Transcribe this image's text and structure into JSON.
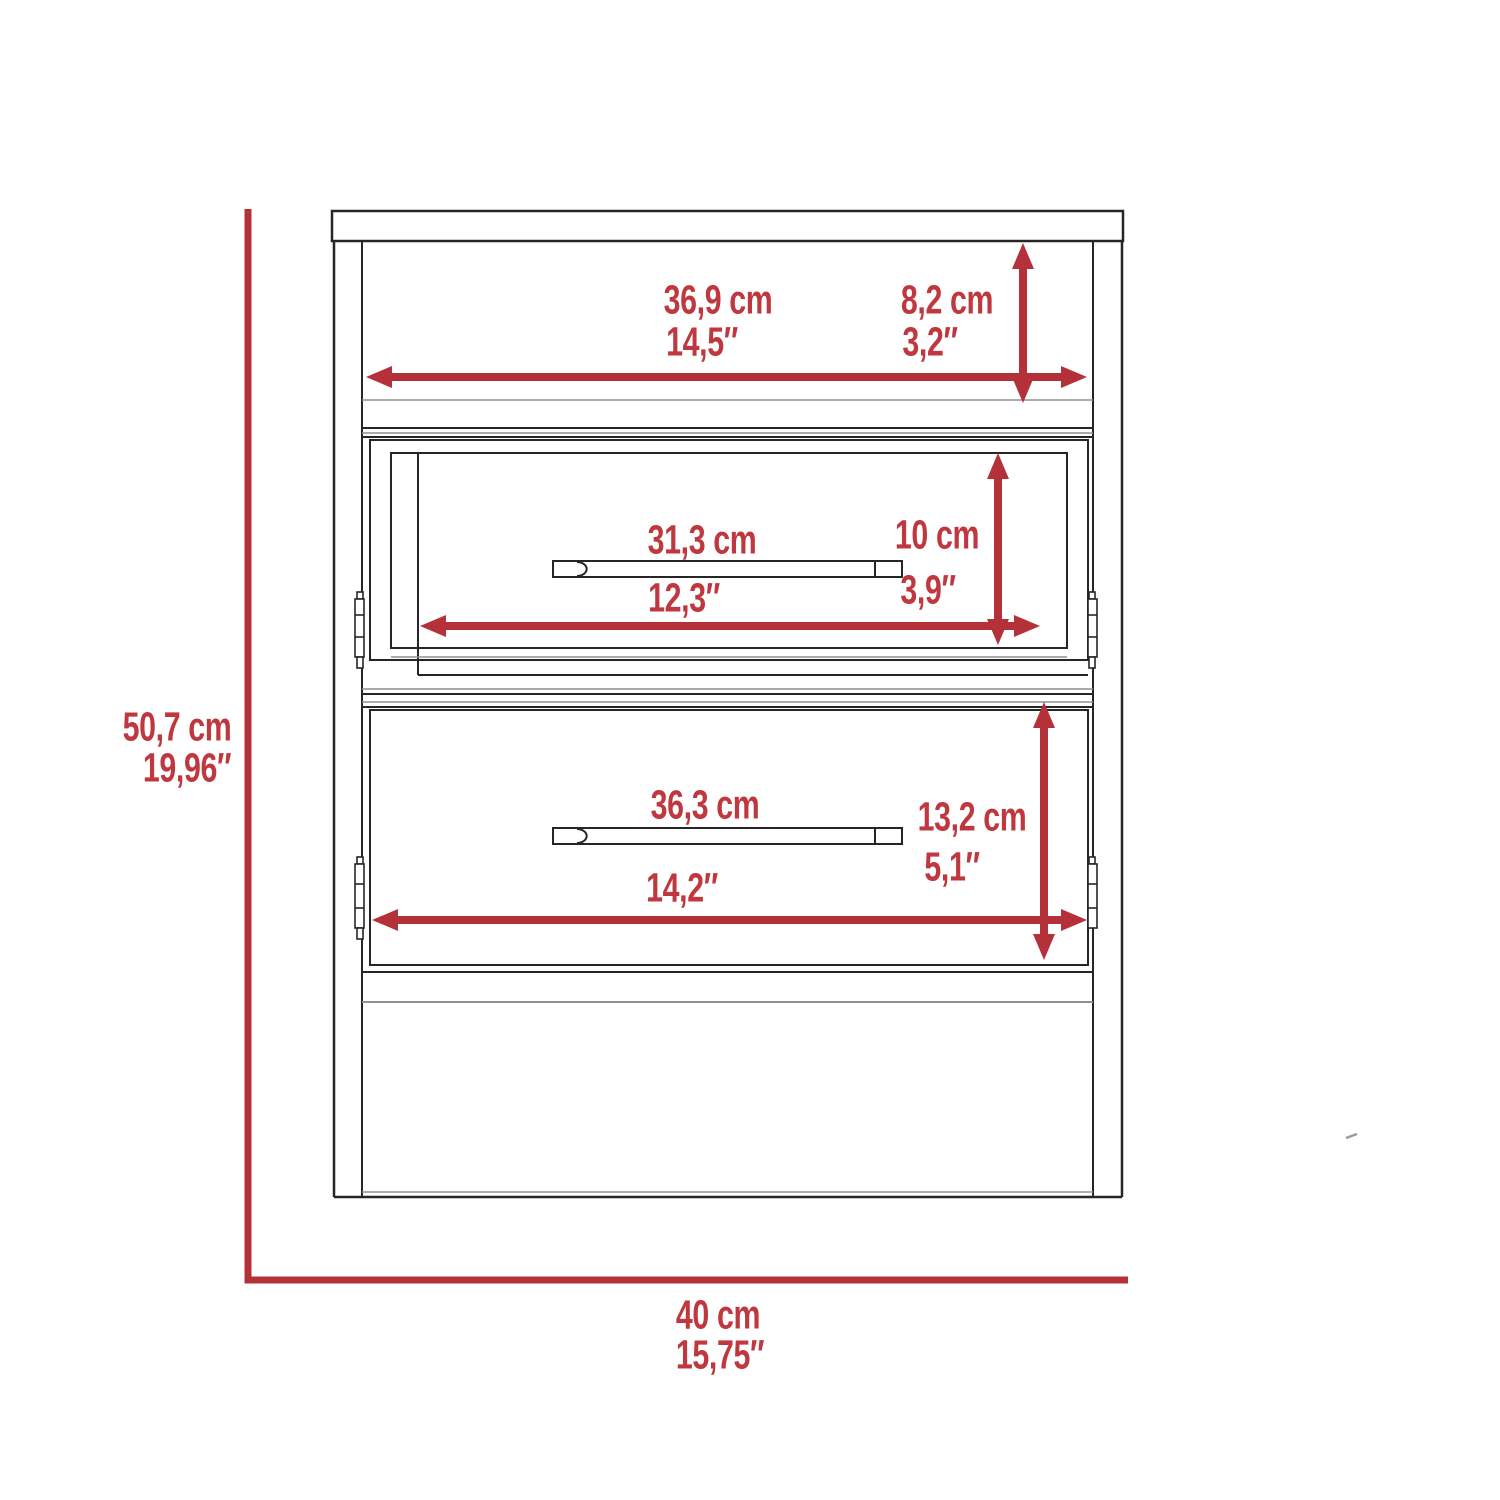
{
  "diagram": {
    "title": "nightstand-two-drawer technical dimension drawing, front view",
    "colors": {
      "dimension_red": "#b5313a",
      "label_red": "#c0383f",
      "line_black": "#262626",
      "line_gray": "#8f8f8f"
    },
    "dimensions": {
      "overall_height": {
        "cm": "50,7 cm",
        "inches": "19,96″"
      },
      "overall_width": {
        "cm": "40 cm",
        "inches": "15,75″"
      },
      "top_shelf_width": {
        "cm": "36,9 cm",
        "inches": "14,5″"
      },
      "top_shelf_height": {
        "cm": "8,2 cm",
        "inches": "3,2″"
      },
      "upper_drawer_width": {
        "cm": "31,3 cm",
        "inches": "12,3″"
      },
      "upper_drawer_height": {
        "cm": "10 cm",
        "inches": "3,9″"
      },
      "lower_drawer_width": {
        "cm": "36,3 cm",
        "inches": "14,2″"
      },
      "lower_drawer_height": {
        "cm": "13,2 cm",
        "inches": "5,1″"
      }
    }
  }
}
